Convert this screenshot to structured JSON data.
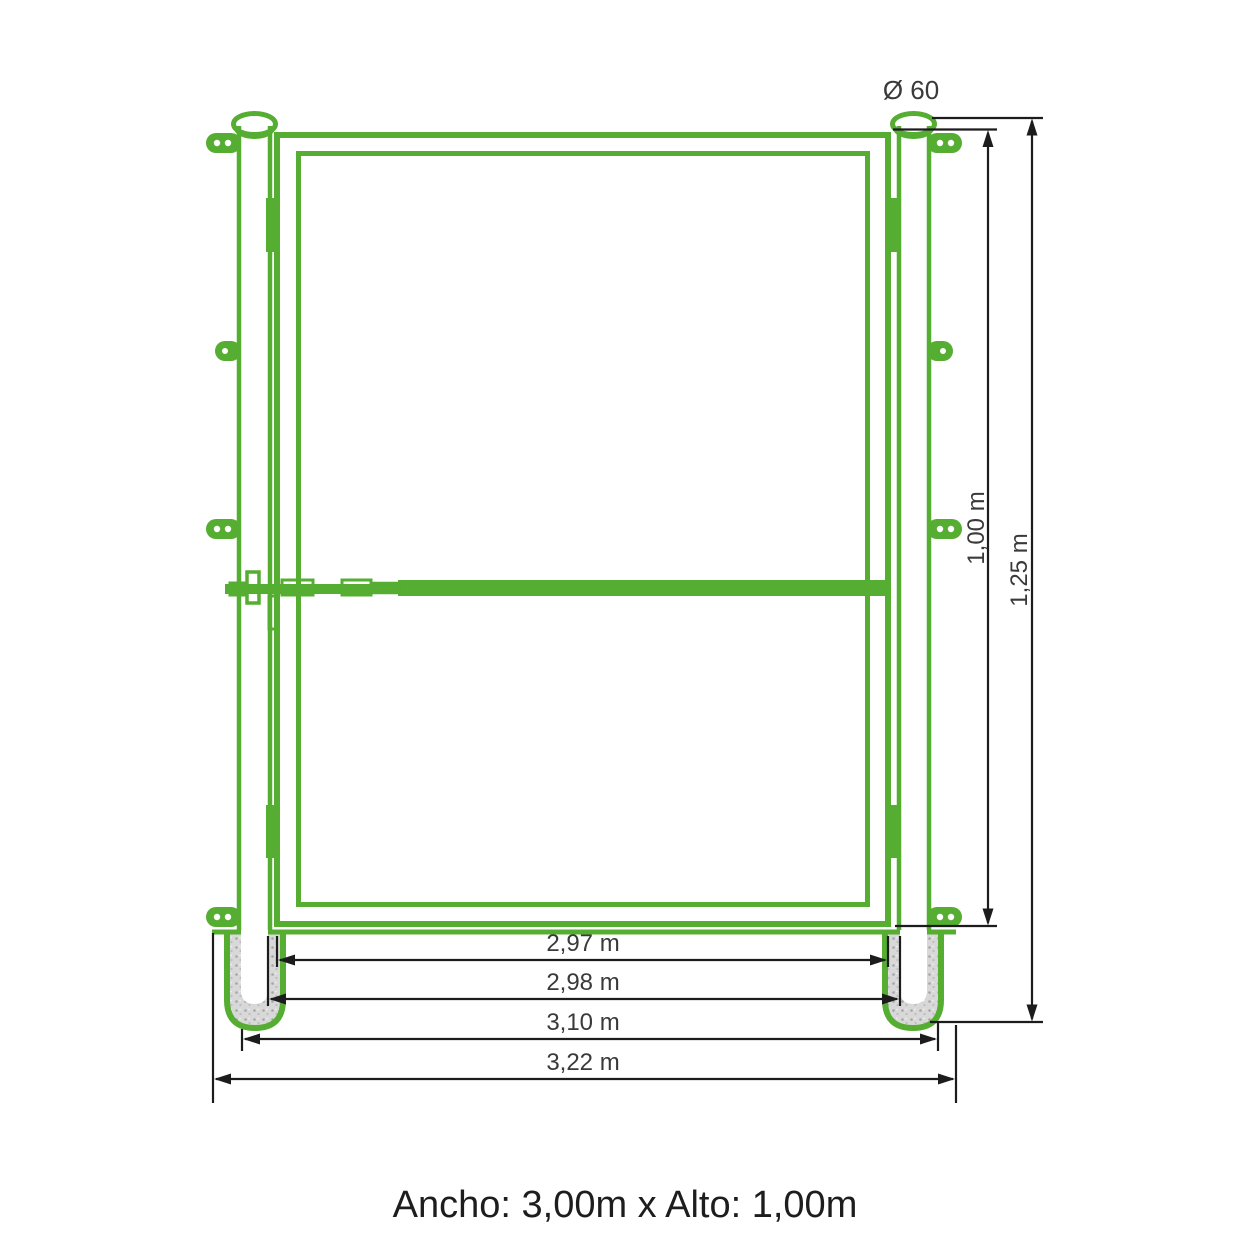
{
  "diagram": {
    "caption": "Ancho: 3,00m x Alto: 1,00m",
    "dimensions": {
      "diameter": "Ø 60",
      "height_gate": "1,00 m",
      "height_total": "1,25 m",
      "width_gate": "2,97 m",
      "width_clear": "2,98 m",
      "width_centers": "3,10 m",
      "width_overall": "3,22 m"
    },
    "colors": {
      "structure_green": "#55ad32",
      "dimension_black": "#1c1c1c",
      "label_gray": "#3a3a3a",
      "concrete_gray": "#d8d8d8"
    }
  }
}
